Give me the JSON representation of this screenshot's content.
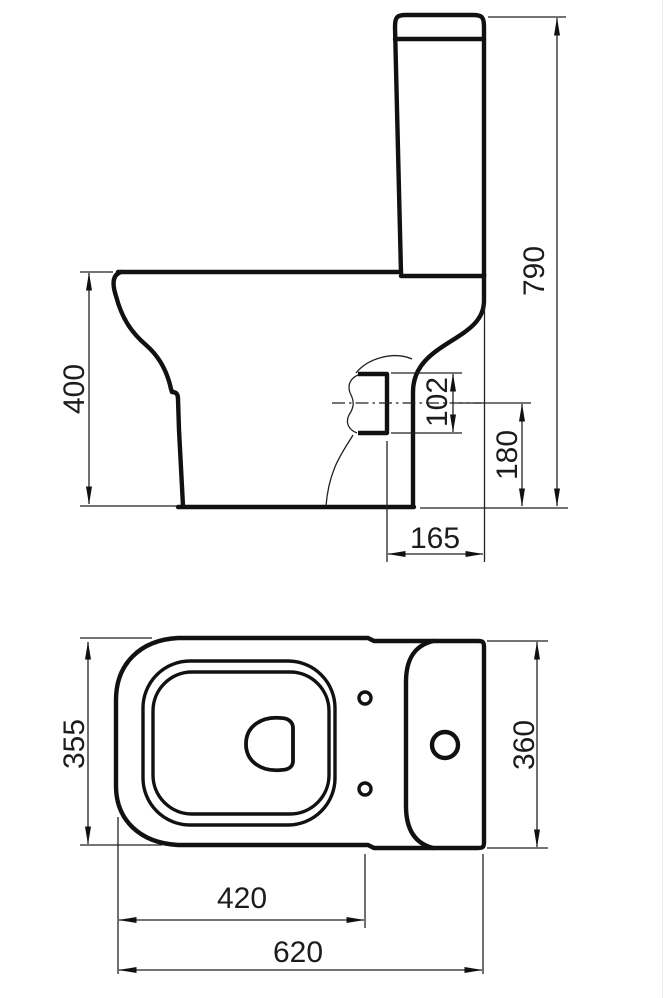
{
  "meta": {
    "description": "Technical dimension drawing of a close-coupled toilet (side elevation above, plan view below)",
    "ink_color": "#111111",
    "background_color": "#ffffff"
  },
  "side_view": {
    "name": "side-elevation",
    "dims": {
      "overall_height": "790",
      "rim_height": "400",
      "outlet_size": "102",
      "outlet_centre_height": "180",
      "outlet_projection": "165"
    }
  },
  "plan_view": {
    "name": "plan-view",
    "dims": {
      "pan_width": "355",
      "cistern_width": "360",
      "front_to_fixing_holes": "420",
      "overall_depth": "620"
    }
  }
}
